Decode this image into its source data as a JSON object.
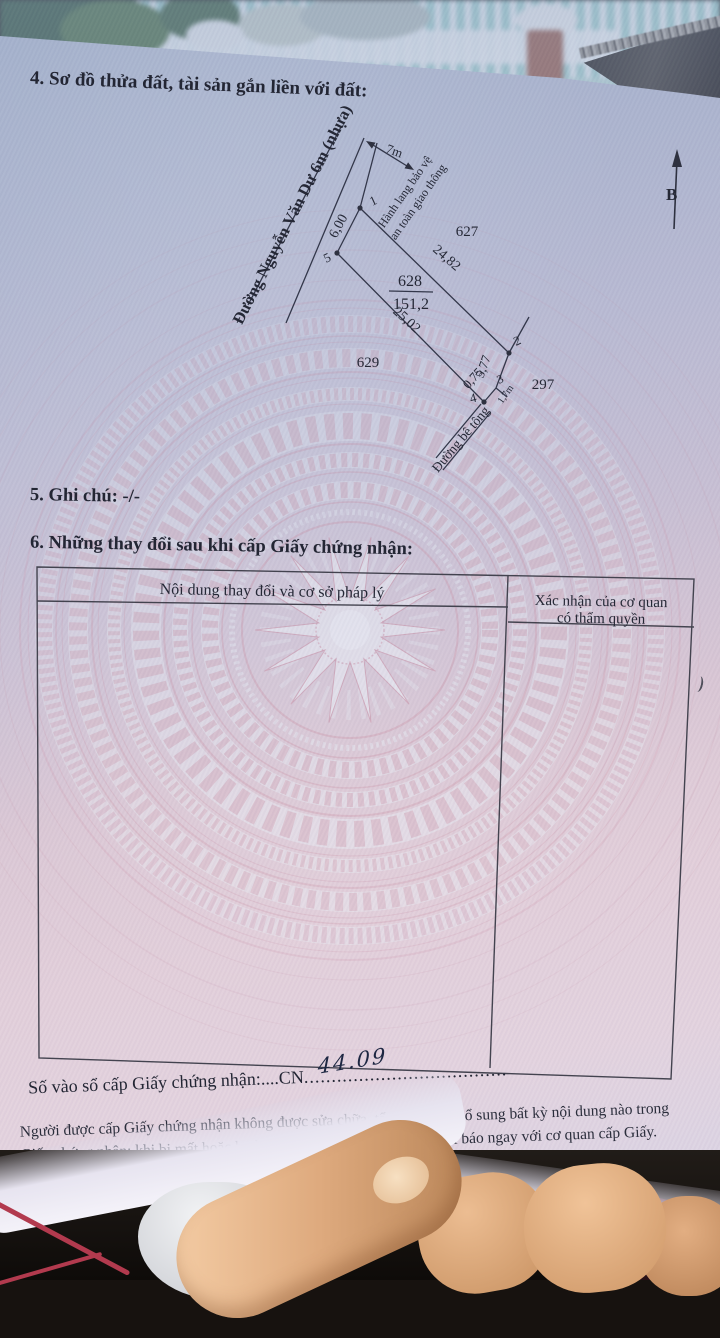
{
  "sections": {
    "s4_title": "4. Sơ đồ thửa đất, tài sản gắn liền với đất:",
    "s5_note": "5. Ghi chú: -/-",
    "s6_title": "6. Những thay đổi sau khi cấp Giấy chứng nhận:"
  },
  "diagram": {
    "road_main": "Đường Nguyễn Văn Dư 6m (nhựa)",
    "corridor_line1": "Hành lang bảo vệ",
    "corridor_line2": "an toàn giao thông",
    "road_concrete": "Đường bê tông",
    "north_label": "B",
    "road_width": "7m",
    "edge_front": "6,00",
    "edge_right": "24,82",
    "edge_left": "25,02",
    "edge_back1": "5,77",
    "edge_back2": "0,75",
    "edge_tick": "1,7m",
    "parcel_number": "628",
    "parcel_area": "151,2",
    "parcel_north": "627",
    "parcel_west": "629",
    "parcel_east": "297",
    "v1": "1",
    "v2": "2",
    "v3": "3",
    "v4": "4",
    "v5": "5"
  },
  "table": {
    "col1_header": "Nội dung thay đổi và cơ sở pháp lý",
    "col2_header_line1": "Xác nhận của cơ quan",
    "col2_header_line2": "có thẩm quyền"
  },
  "registry": {
    "label": "Số vào sổ cấp Giấy chứng nhận:....",
    "code": "CN",
    "dots": ".....................................",
    "handwritten": "44.09"
  },
  "footer": {
    "line1": "Người được cấp Giấy chứng nhận không được sửa chữa, tẩy xóa hoặc bổ sung bất kỳ nội dung nào trong",
    "line2": "Giấy chứng nhận; khi bị mất hoặc hư hỏng Giấy chứng nhận phải khai báo ngay với cơ quan cấp Giấy."
  },
  "colors": {
    "paper_pink": "#e3ccd6",
    "paper_blue": "#b9c3d6",
    "pattern_pink": "#cf9fb2",
    "pattern_pale": "#e8edf5",
    "ink": "#272a38",
    "handwriting_ink": "#1d2742"
  }
}
